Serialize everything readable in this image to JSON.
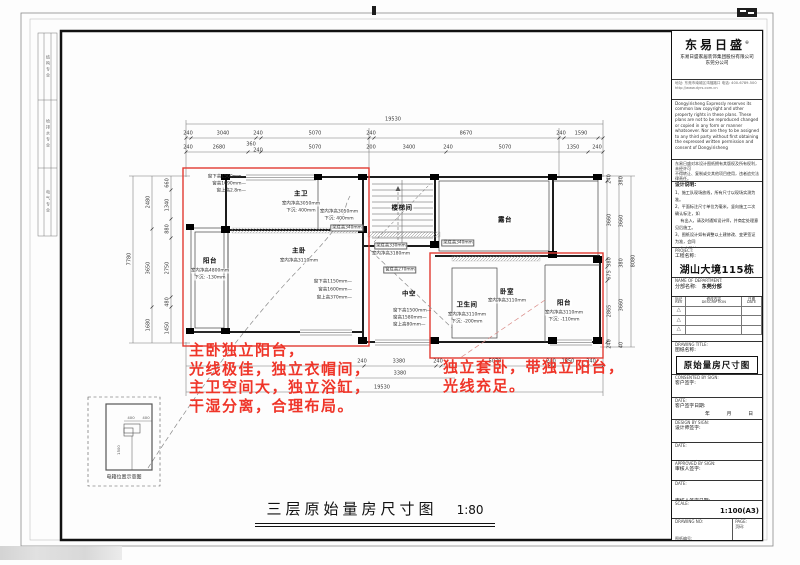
{
  "frame": {
    "strip_cells": [
      "结构专业",
      "给排水专业",
      "电气专业"
    ]
  },
  "title_block": {
    "logo": "东易日盛",
    "logo_sup": "®",
    "company": "东易日盛家居装饰集团股份有限公司",
    "branch": "东莞分公司",
    "contact1": "地址: 东莞市南城区鸿福路口  电话: 400-6789-500",
    "contact2": "http://www.dyrs.com.cn",
    "copyright_en": "Dongyirisheng Expressly reserves its common law copyright and other property rights in these plans. These plans are not to be reproduced changed or copied in any form or manner whatsoever. Nor are they to be assigned to any third party without first obtaining the expressed written permission and consent of Dongyirisheng",
    "copyright_cn1": "东易日盛对本设计图纸拥有其版权及所有权利，未经许可",
    "copyright_cn2": "不得转让、复制或交其他项目使用，违者追究法律责任。",
    "notes_title": "设计说明:",
    "notes": [
      "1、施工队现场放线，所有尺寸以现场实测为准。",
      "2、平面标注尺寸单位为毫米，竖向施工二次确认标注，如",
      "　 有出入，请及时通知设计师，并商定处理意见后施工。",
      "3、图纸设计如有调整以土建修改、变更签证为准，会同",
      "　 各方确认。",
      "4、经甲乙双方确认施工图后，双方（客户和业主方）签字",
      "　 后下单，方可进场施工。"
    ],
    "project_en": "PROJECT:",
    "project_cn": "工程名称:",
    "project_name": "湖山大境115栋02",
    "dept_en": "NAME OF DEPARTMENT:",
    "dept_cn": "分部名称:",
    "dept_name": "东莞分部",
    "rev_c1a": "标记",
    "rev_c1b": "REV",
    "rev_c2a": "修改内容",
    "rev_c2b": "DESCRIPTION",
    "rev_c3a": "日期",
    "rev_c3b": "DATE",
    "rev_mark": "△",
    "dwg_title_en": "DRAWING TITLE:",
    "dwg_title_cn": "图纸名称:",
    "dwg_title": "原始量房尺寸图",
    "s1_en": "CONSENTED BY SIGN:",
    "s1_cn": "客户签字:",
    "s2_en": "DATE:",
    "s2_cn": "客户签字日期:",
    "s2_v": "年　月　日",
    "s3_en": "DESIGN BY SIGN:",
    "s3_cn": "设计师签字:",
    "s4_en": "DATE:",
    "s4_cn": "设计师签字日期:",
    "s4_v": "年　月　日",
    "s5_en": "APPROVED BY SIGN:",
    "s5_cn": "审核人签字:",
    "s6_en": "DATE:",
    "s6_cn": "审核人签字日期:",
    "s6_v": "年　月　日",
    "scale_en": "SCALE:",
    "scale_cn": "比例:",
    "scale_v": "1:100(A3)",
    "no_en": "DRAWING NO:",
    "no_cn": "图纸编号:",
    "no_v": "YP-01",
    "page_en": "PAGE:",
    "page_cn": "页码:"
  },
  "plan": {
    "rooms": {
      "zhuwei": {
        "name": "主卫",
        "n1": "室内净高3050mm",
        "n2": "下沉: 400mm"
      },
      "cloak": {
        "n1": "室内净高3050mm",
        "n2": "下沉: 400mm"
      },
      "stair": {
        "name": "楼梯间"
      },
      "terrace": {
        "name": "露台"
      },
      "balcony_l": {
        "name": "阳台",
        "n1": "室内净高4800mm",
        "n2": "下沉: -130mm"
      },
      "master": {
        "name": "主卧",
        "n1": "室内净高3110mm"
      },
      "void": {
        "name": "中空"
      },
      "bath": {
        "name": "卫生间",
        "n1": "室内净高3110mm",
        "n2": "下沉: -200mm"
      },
      "bedroom": {
        "name": "卧室",
        "n1": "室内净高3110mm"
      },
      "balcony_r": {
        "name": "阳台",
        "n1": "室内净高3110mm",
        "n2": "下沉: -110mm"
      }
    },
    "windows": {
      "w1": [
        "窗下高1500mm—",
        "窗高1090mm—",
        "窗上高2.8m—"
      ],
      "w2": [
        "窗下高1150mm—",
        "窗高1600mm—",
        "窗上高370mm—"
      ],
      "w3": [
        "窗下高1500mm—",
        "窗高1580mm—",
        "窗上高80mm—"
      ]
    },
    "beams": {
      "b1": "梁底高340mm",
      "b2": "梁底高330mm",
      "b2b": "室内净高3180mm",
      "b3": "梁底高340mm",
      "b4": "窗底高270mm"
    },
    "dims": {
      "top_total": "19530",
      "top_row1": [
        "240",
        "3040",
        "240",
        "5070",
        "240",
        "8670",
        "240",
        "1590"
      ],
      "top_row2": [
        "240",
        "2680",
        "360",
        "240",
        "5070",
        "200",
        "3400",
        "240",
        "5070",
        "1350",
        "240"
      ],
      "bottom_row1": [
        "240",
        "3380",
        "240",
        "5070",
        "240",
        "1350",
        "240"
      ],
      "bottom_row2": [
        "3380"
      ],
      "bottom_total": "19530",
      "left_inner": [
        "660",
        "1340",
        "880",
        "2750",
        "480",
        "1450"
      ],
      "left_mid": [
        "2480",
        "3650",
        "1680"
      ],
      "left_outer": "7780",
      "right_inner": [
        "240",
        "3660",
        "380",
        "675",
        "2865",
        "240"
      ],
      "right_mid": [
        "380",
        "3660",
        "380",
        "3660",
        "40"
      ],
      "right_outer": "8080"
    },
    "detail": {
      "label": "电箱位置示意图",
      "d1": "400",
      "d2": "400",
      "d3": "1500"
    }
  },
  "annotations": {
    "red_color": "#ef3529",
    "left_red": [
      "主卧独立阳台，",
      "光线极佳，独立衣帽间，",
      "主卫空间大，独立浴缸，",
      "干湿分离，合理布局。"
    ],
    "right_red": [
      "独立套卧，带独立阳台，",
      "光线充足。"
    ]
  },
  "footer": {
    "title": "三层原始量房尺寸图",
    "scale": "1:80"
  }
}
